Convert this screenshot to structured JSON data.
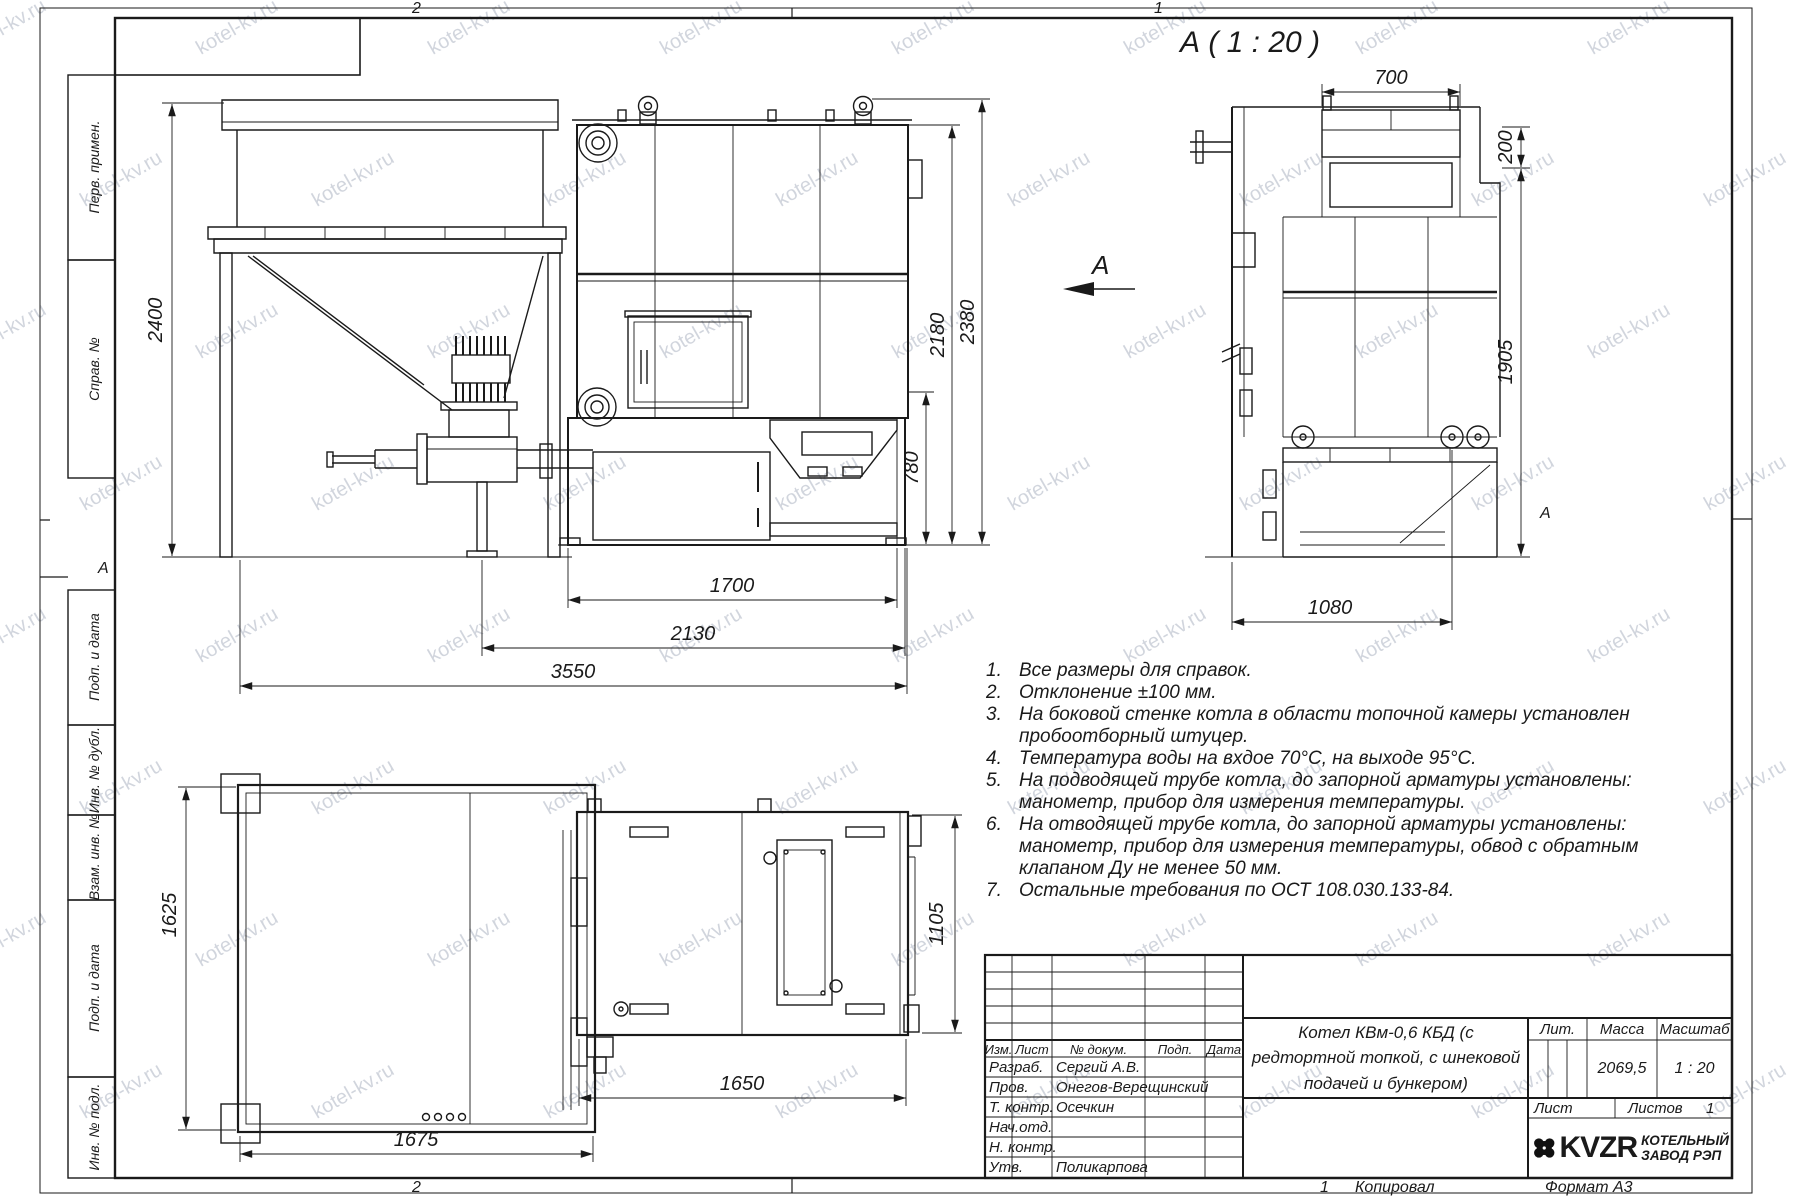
{
  "sheet": {
    "watermark": "kotel-kv.ru",
    "zone_top_left": "2",
    "zone_top_right": "1",
    "zone_bottom_left": "2",
    "fold_marker_left": "А",
    "fold_marker_right": "А",
    "bottom_row": {
      "sheet_num": "1",
      "copied": "Копировал",
      "format": "Формат А3"
    }
  },
  "margin_labels": [
    "Перв. примен.",
    "Справ. №",
    "Подп. и дата",
    "Инв. № дубл.",
    "Взам. инв. №",
    "Подп. и дата",
    "Инв. № подл."
  ],
  "section": {
    "title": "А ( 1 : 20 )",
    "arrow_label": "А"
  },
  "dims": {
    "d2400": "2400",
    "d1700": "1700",
    "d2130": "2130",
    "d3550": "3550",
    "d780": "780",
    "d2180": "2180",
    "d2380": "2380",
    "d700": "700",
    "d200": "200",
    "d1905": "1905",
    "d1080": "1080",
    "d1625": "1625",
    "d1675": "1675",
    "d1650": "1650",
    "d1105": "1105"
  },
  "notes": [
    {
      "n": "1.",
      "t": "Все размеры для справок."
    },
    {
      "n": "2.",
      "t": "Отклонение ±100 мм."
    },
    {
      "n": "3.",
      "t": "На боковой стенке котла в области топочной камеры установлен"
    },
    {
      "n": "",
      "t": "пробоотборный штуцер."
    },
    {
      "n": "4.",
      "t": "Температура воды на вхдое 70°С, на выходе 95°С."
    },
    {
      "n": "5.",
      "t": "На подводящей трубе котла, до запорной арматуры установлены:"
    },
    {
      "n": "",
      "t": "манометр, прибор для измерения температуры."
    },
    {
      "n": "6.",
      "t": "На отводящей трубе котла, до запорной арматуры установлены:"
    },
    {
      "n": "",
      "t": "манометр, прибор для измерения температуры, обвод с обратным"
    },
    {
      "n": "",
      "t": "клапаном Ду не менее 50 мм."
    },
    {
      "n": "7.",
      "t": "Остальные требования по ОСТ 108.030.133-84."
    }
  ],
  "title_block": {
    "header": {
      "izm": "Изм.",
      "list": "Лист",
      "doc": "№ докум.",
      "podp": "Подп.",
      "data": "Дата"
    },
    "rows": [
      {
        "label": "Разраб.",
        "value": "Сергий А.В."
      },
      {
        "label": "Пров.",
        "value": "Онегов-Верещинский"
      },
      {
        "label": "Т. контр.",
        "value": "Осечкин"
      },
      {
        "label": "Нач.отд.",
        "value": ""
      },
      {
        "label": "Н. контр.",
        "value": ""
      },
      {
        "label": "Утв.",
        "value": "Поликарпова"
      }
    ],
    "doc_title": "Котел КВм-0,6 КБД (с редтортной топкой, с шнековой подачей и бункером)",
    "lit": "Лит.",
    "mass": "Масса",
    "scale": "Масштаб",
    "mass_value": "2069,5",
    "scale_value": "1 : 20",
    "sheet": "Лист",
    "sheets": "Листов",
    "sheets_value": "1",
    "logo": "KVZR",
    "company1": "КОТЕЛЬНЫЙ",
    "company2": "ЗАВОД РЭП"
  }
}
